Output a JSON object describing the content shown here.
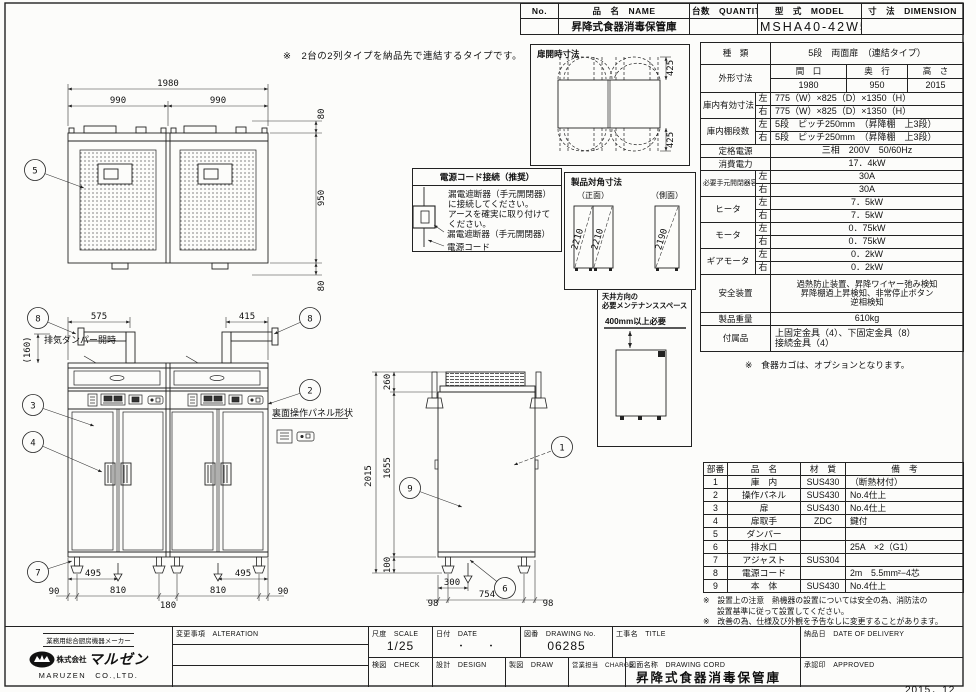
{
  "header_table": {
    "no_label": "No.",
    "name_label": "品　名　NAME",
    "qty_label": "台数　QUANTITY",
    "model_label": "型　式　MODEL",
    "dim_label": "寸　法　DIMENSION",
    "name_value": "昇降式食器消毒保管庫",
    "model_value": "MSHA40-42W5E"
  },
  "top_note": "※　2台の2列タイプを納品先で連結するタイプです。",
  "door_open_box": {
    "title": "扉開時寸法",
    "dim_top": "425",
    "dim_bottom": "425"
  },
  "spec_table": {
    "kind_label": "種　類",
    "kind_value": "5段　両面扉　（連結タイプ）",
    "outer_label": "外形寸法",
    "outer_c1": "間　口",
    "outer_c2": "奥　行",
    "outer_c3": "高　さ",
    "outer_v1": "1980",
    "outer_v2": "950",
    "outer_v3": "2015",
    "l": "左",
    "r": "右",
    "inner_label": "庫内有効寸法",
    "inner_l": "775（W）×825（D）×1350（H）",
    "inner_r": "775（W）×825（D）×1350（H）",
    "shelf_label": "庫内棚段数",
    "shelf_l": "5段　ピッチ250mm　（昇降棚　上3段）",
    "shelf_r": "5段　ピッチ250mm　（昇降棚　上3段）",
    "supply_label": "定格電源",
    "supply_value": "三相　200V　50/60Hz",
    "consumption_label": "消費電力",
    "consumption_value": "17．4kW",
    "breaker_label": "必要手元開閉器容量",
    "breaker_l": "30A",
    "breaker_r": "30A",
    "heater_label": "ヒータ",
    "heater_l": "7．5kW",
    "heater_r": "7．5kW",
    "motor_label": "モータ",
    "motor_l": "0．75kW",
    "motor_r": "0．75kW",
    "gear_label": "ギアモータ",
    "gear_l": "0．2kW",
    "gear_r": "0．2kW",
    "safety_label": "安全装置",
    "safety_1": "過熱防止装置、昇降ワイヤー弛み検知",
    "safety_2": "昇降棚過上昇検知、非常停止ボタン",
    "safety_3": "逆相検知",
    "weight_label": "製品重量",
    "weight_value": "610kg",
    "acc_label": "付属品",
    "acc_1": "上固定金具（4）、下固定金具（8）",
    "acc_2": "接続金具（4）"
  },
  "basket_note": "※　食器カゴは、オプションとなります。",
  "power_box": {
    "title": "電源コード接続（推奨）",
    "line1": "漏電遮断器（手元開閉器）",
    "line2": "に接続してください。",
    "line3": "アースを確実に取り付けて",
    "line4": "ください。",
    "breaker_label": "漏電遮断器（手元開閉器）",
    "cord_label": "電源コード"
  },
  "diagonal_box": {
    "title": "製品対角寸法",
    "front_label": "（正面）",
    "side_label": "（側面）",
    "diag_front1": "2210",
    "diag_front2": "2210",
    "diag_side": "2190"
  },
  "maintenance_box": {
    "title1": "天井方向の",
    "title2": "必要メンテナンススペース",
    "clearance": "400mm以上必要"
  },
  "parts_table": {
    "h_no": "部番",
    "h_name": "品　名",
    "h_mat": "材　質",
    "h_note": "備　考",
    "rows": [
      {
        "no": "1",
        "name": "庫　内",
        "mat": "SUS430",
        "note": "（断熱材付）"
      },
      {
        "no": "2",
        "name": "操作パネル",
        "mat": "SUS430",
        "note": "No.4仕上"
      },
      {
        "no": "3",
        "name": "扉",
        "mat": "SUS430",
        "note": "No.4仕上"
      },
      {
        "no": "4",
        "name": "扉取手",
        "mat": "ZDC",
        "note": "鍵付"
      },
      {
        "no": "5",
        "name": "ダンパー",
        "mat": "",
        "note": ""
      },
      {
        "no": "6",
        "name": "排水口",
        "mat": "",
        "note": "25A　×2（G1）"
      },
      {
        "no": "7",
        "name": "アジャスト",
        "mat": "SUS304",
        "note": ""
      },
      {
        "no": "8",
        "name": "電源コード",
        "mat": "",
        "note": "2m　5.5mm²−4芯"
      },
      {
        "no": "9",
        "name": "本　体",
        "mat": "SUS430",
        "note": "No.4仕上"
      }
    ]
  },
  "install_notes": [
    "※　設置上の注意　熱機器の設置については安全の為、消防法の",
    "設置基準に従って設置してください。",
    "※　改善の為、仕様及び外観を予告なしに変更することがあります。"
  ],
  "title_block": {
    "alteration": "変更事項　ALTERATION",
    "scale_label": "尺度　SCALE",
    "scale_value": "1/25",
    "date_label": "日付　DATE",
    "date_value": "・　　・",
    "no_label": "図番　DRAWING No.",
    "no_value": "06285",
    "title_label": "工事名　TITLE",
    "check": "検図　CHECK",
    "design": "設計　DESIGN",
    "draw": "製図　DRAW",
    "charge": "営業担当　CHARGE",
    "dwg_name_label": "図面名称　DRAWING CORD",
    "dwg_name_value": "昇降式食器消毒保管庫",
    "delivery": "納品日　DATE OF DELIVERY",
    "approved": "承認印　APPROVED"
  },
  "logo": {
    "tagline": "業務用総合厨房機器メーカー",
    "prefix": "株式会社",
    "name": "マルゼン",
    "en": "MARUZEN　CO.,LTD."
  },
  "revision_date": "2015．12",
  "views": {
    "plan": {
      "w_total": "1980",
      "w_left": "990",
      "w_right": "990",
      "d_top": "80",
      "depth": "950",
      "d_bottom": "80"
    },
    "front": {
      "duct_left": "575",
      "duct_right": "415",
      "damper_dim": "(160)",
      "damper_label": "排気ダンパー開時",
      "rear_panel_label": "裏面操作パネル形状",
      "drain_left": "495",
      "drain_right": "495",
      "leg1": "90",
      "leg2": "810",
      "leg3": "180",
      "leg4": "810",
      "leg5": "90"
    },
    "side": {
      "h_total": "2015",
      "h_body": "1655",
      "h_top": "260",
      "h_leg": "100",
      "drain": "300",
      "foot1": "98",
      "foot2": "754",
      "foot3": "98"
    }
  },
  "callouts": {
    "1": "1",
    "2": "2",
    "3": "3",
    "4": "4",
    "5": "5",
    "6": "6",
    "7": "7",
    "8": "8",
    "9": "9"
  }
}
